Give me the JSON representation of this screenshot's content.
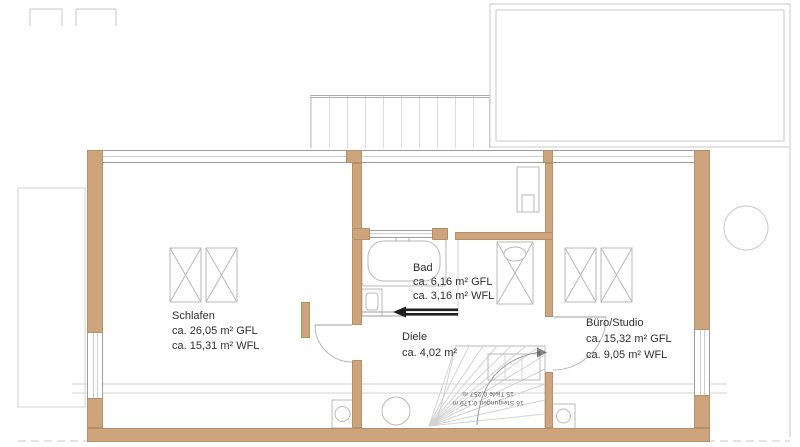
{
  "drawing_type": "floor-plan",
  "rooms": [
    {
      "name": "Schlafen",
      "area_gfl": "ca. 26,05 m² GFL",
      "area_wfl": "ca. 15,31 m² WFL"
    },
    {
      "name": "Bad",
      "area_gfl": "ca. 6,16 m² GFL",
      "area_wfl": "ca. 3,16 m² WFL"
    },
    {
      "name": "Diele",
      "area_gfl": "ca. 4,02 m²"
    },
    {
      "name": "Büro/Studio",
      "area_gfl": "ca. 15,32 m² GFL",
      "area_wfl": "ca. 9,05 m² WFL"
    }
  ],
  "stairs": {
    "risers": "16 Steigungen 0,179 m",
    "treads": "15 Tiefe 0,257 m"
  },
  "colors": {
    "wall": "#cda47c",
    "line_gray": "#b9b9b9",
    "text": "#2f2f2f"
  }
}
